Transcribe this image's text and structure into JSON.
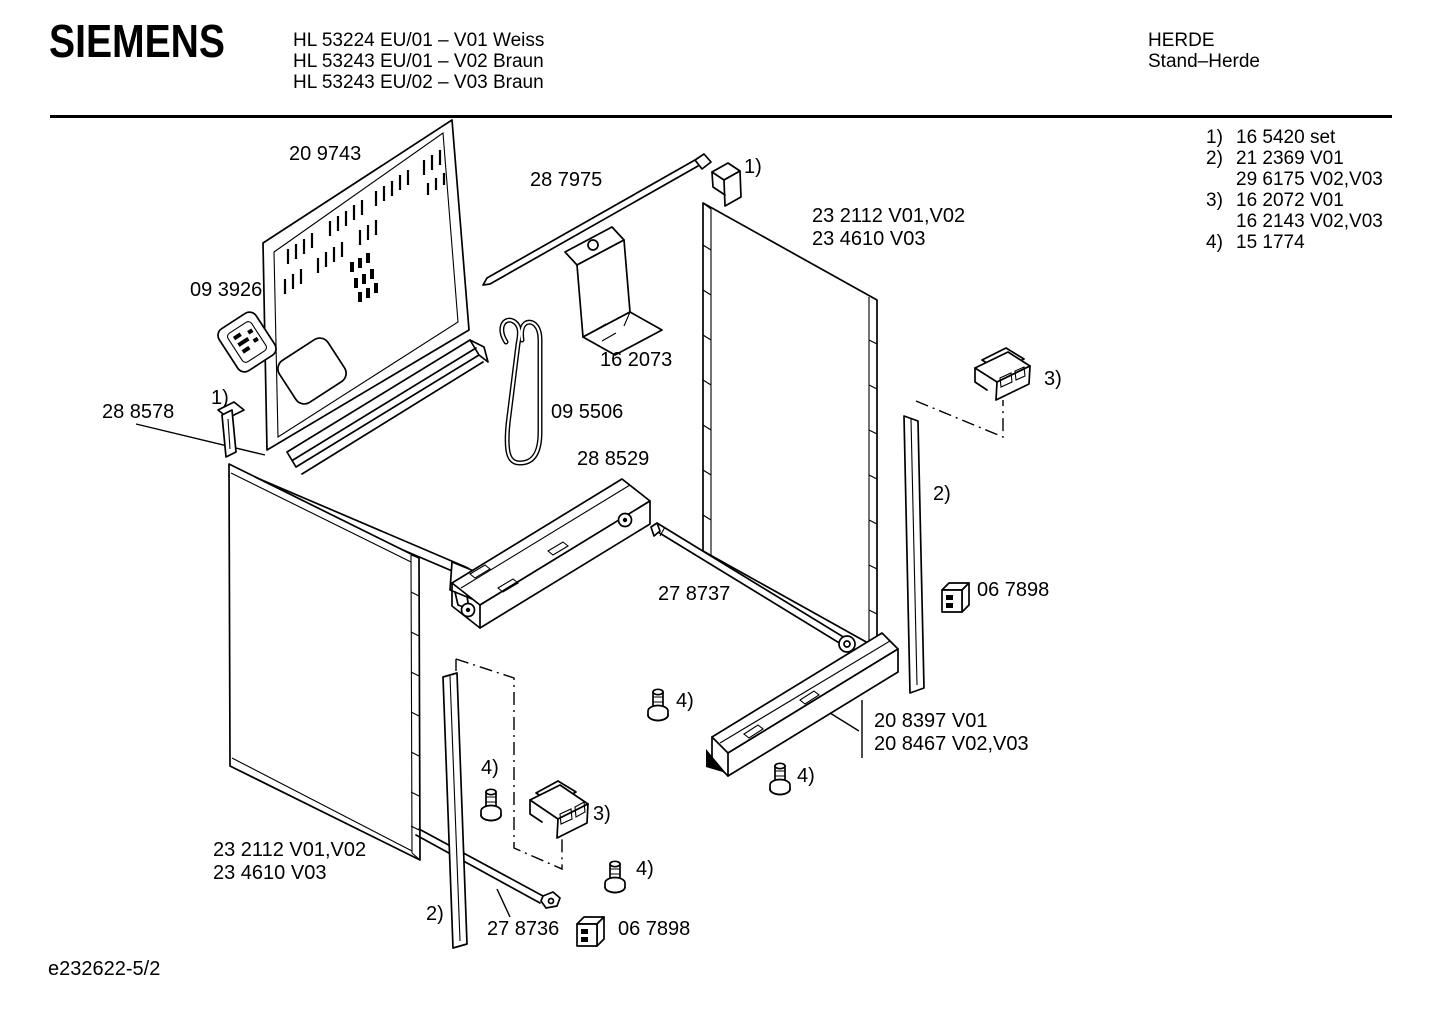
{
  "header": {
    "brand": "SIEMENS",
    "models": [
      "HL 53224 EU/01 – V01 Weiss",
      "HL 53243 EU/01 – V02 Braun",
      "HL 53243 EU/02 – V03 Braun"
    ],
    "category": "HERDE",
    "subcategory": "Stand–Herde"
  },
  "legend": {
    "rows": [
      {
        "ref": "1)",
        "text": "16 5420 set"
      },
      {
        "ref": "2)",
        "text": "21 2369 V01"
      },
      {
        "ref": "",
        "text": "29 6175 V02,V03"
      },
      {
        "ref": "3)",
        "text": "16 2072 V01"
      },
      {
        "ref": "",
        "text": "16 2143 V02,V03"
      },
      {
        "ref": "4)",
        "text": "15 1774"
      }
    ]
  },
  "diagram": {
    "part_labels": {
      "back_panel": "20 9743",
      "top_rail": "28 7975",
      "terminal_block": "09 3926",
      "fixing_clip": "28 8578",
      "side_panel_right_line1": "23 2112 V01,V02",
      "side_panel_right_line2": "23 4610 V03",
      "bracket": "16 2073",
      "cable_clamp": "09 5506",
      "support_rail": "28 8529",
      "cross_rail_right": "27 8737",
      "clip_right": "06 7898",
      "base_rail_line1": "20 8397 V01",
      "base_rail_line2": "20 8467 V02,V03",
      "side_panel_left_line1": "23 2112 V01,V02",
      "side_panel_left_line2": "23 4610 V03",
      "cross_rail_front": "27 8736",
      "clip_front": "06 7898"
    },
    "ref_markers": {
      "clip_top": "1)",
      "clip_left": "1)",
      "trim_strip_right": "2)",
      "trim_strip_front": "2)",
      "connector_right": "3)",
      "connector_front": "3)",
      "screw_a": "4)",
      "screw_b": "4)",
      "screw_c": "4)",
      "screw_d": "4)"
    }
  },
  "footer": {
    "doc_number": "e232622-5/2"
  }
}
